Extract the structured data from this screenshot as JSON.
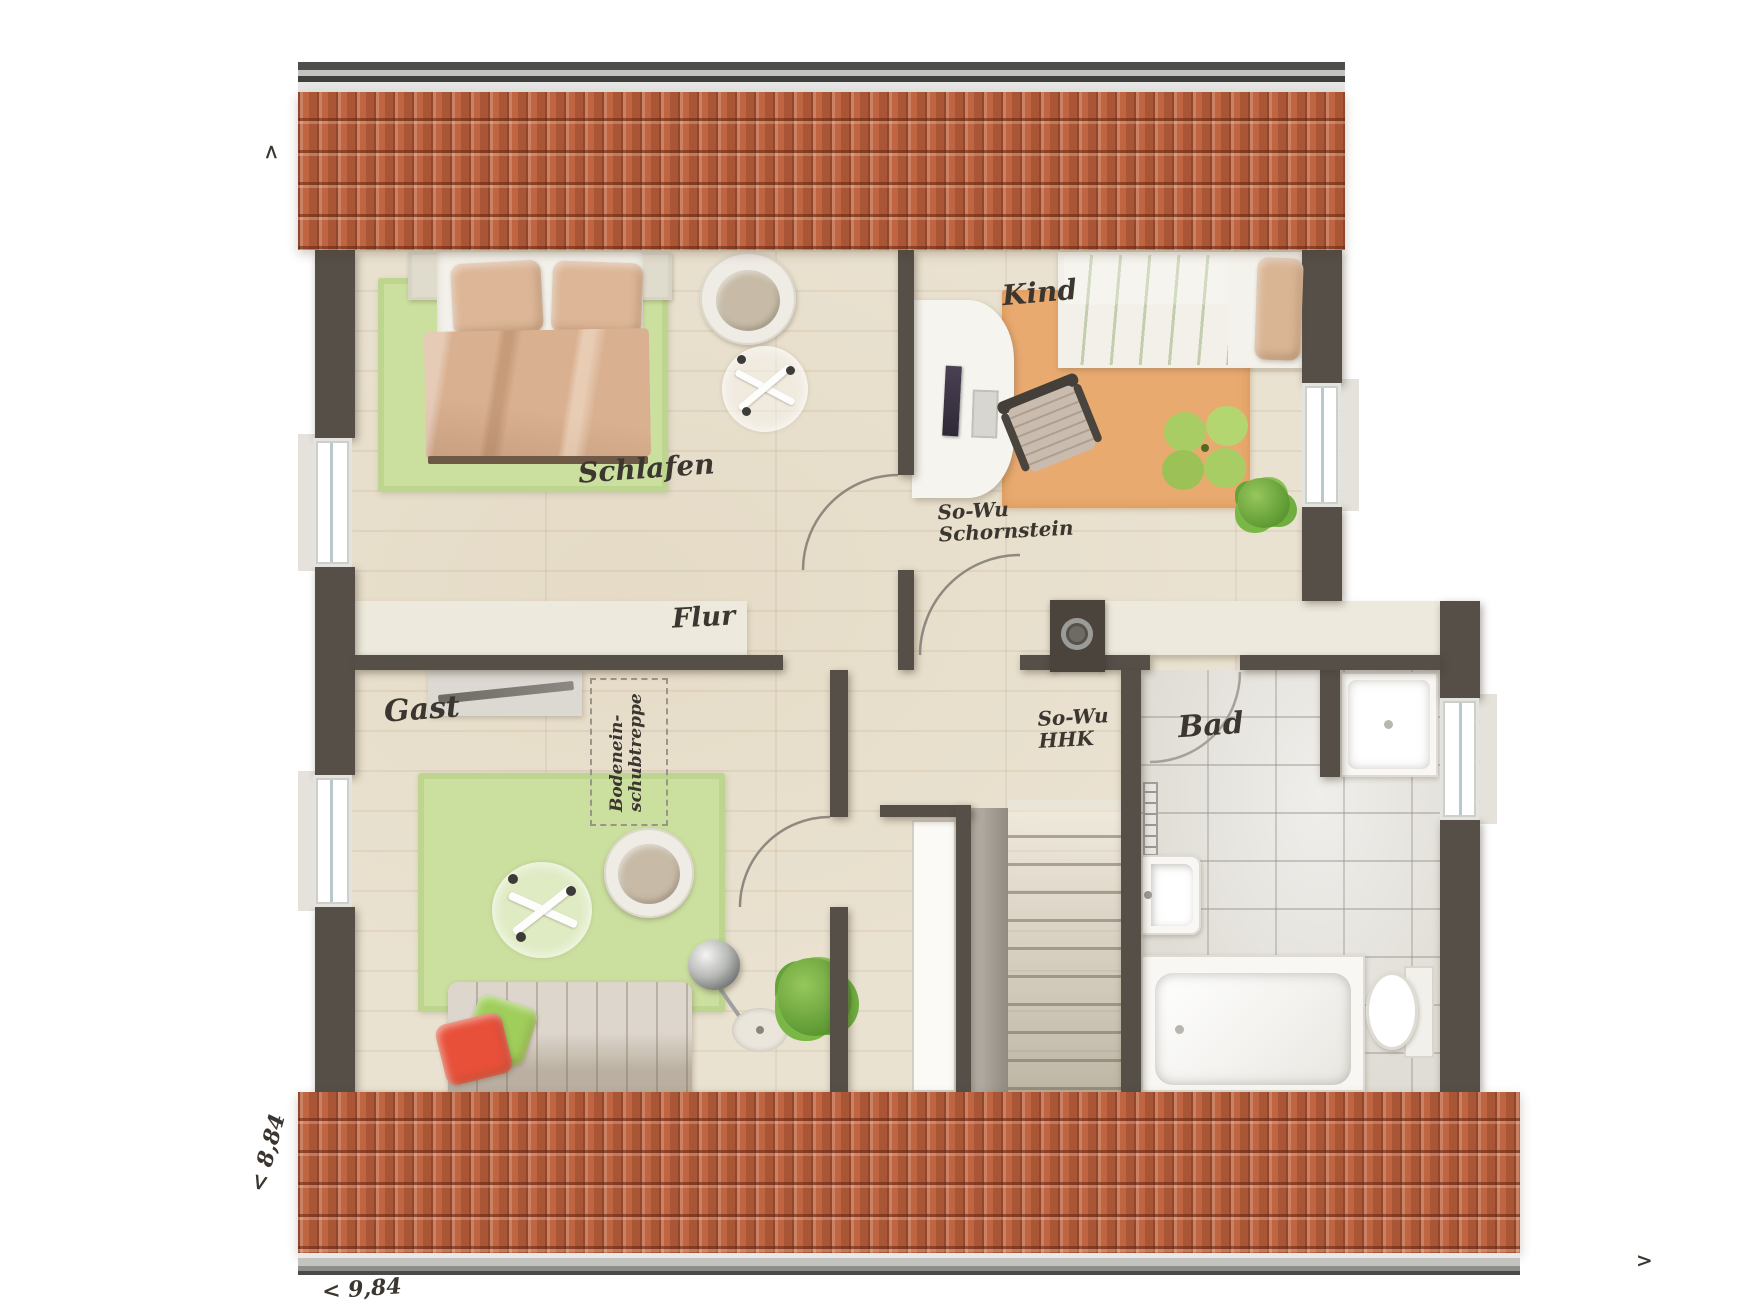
{
  "plan": {
    "type": "floorplan-dachgeschoss",
    "style": "top-down architectural rendering"
  },
  "rooms": [
    {
      "id": "schlafen",
      "label": "Schlafen"
    },
    {
      "id": "kind",
      "label": "Kind"
    },
    {
      "id": "flur",
      "label": "Flur"
    },
    {
      "id": "gast",
      "label": "Gast"
    },
    {
      "id": "bad",
      "label": "Bad"
    }
  ],
  "annotations": {
    "chimney": {
      "line1": "So-Wu",
      "line2": "Schornstein"
    },
    "radiator": {
      "line1": "So-Wu",
      "line2": "HHK"
    },
    "loft_ladder": {
      "line1": "Bodenein-",
      "line2": "schubtreppe"
    }
  },
  "dimensions": {
    "width_label": "< 9,84",
    "height_label": "< 8,84"
  },
  "compass": {
    "top_left_arrow": ">",
    "bottom_right_arrow": ">"
  },
  "colors": {
    "roof_tile": "#bf6542",
    "wall": "#554f48",
    "wood_floor": "#eae2d1",
    "bath_tile": "#e0ddd6",
    "rug_green": "#cbdf9f",
    "rug_orange": "#e9aa70",
    "knee_wall": "#edeadd",
    "bed_blanket_peach": "#d9b191",
    "kid_bed_green": "#b9d783",
    "sofa_red_pillow": "#e8503a",
    "sofa_green_pillow": "#9fce5a",
    "label_ink": "#3c3630"
  },
  "furniture_icons": [
    "double-bed-icon",
    "green-rug-icon",
    "armchair-icon",
    "glass-table-icon",
    "desk-icon",
    "monitor-icon",
    "keyboard-icon",
    "desk-chair-icon",
    "single-bed-icon",
    "play-rug-icon",
    "flower-cushion-icon",
    "plant-icon",
    "sideboard-icon",
    "sofa-icon",
    "floor-lamp-icon",
    "staircase-icon",
    "loft-ladder-icon",
    "chimney-icon",
    "shower-icon",
    "sink-icon",
    "bathtub-icon",
    "toilet-icon",
    "radiator-icon",
    "window-icon",
    "door-swing-icon"
  ]
}
